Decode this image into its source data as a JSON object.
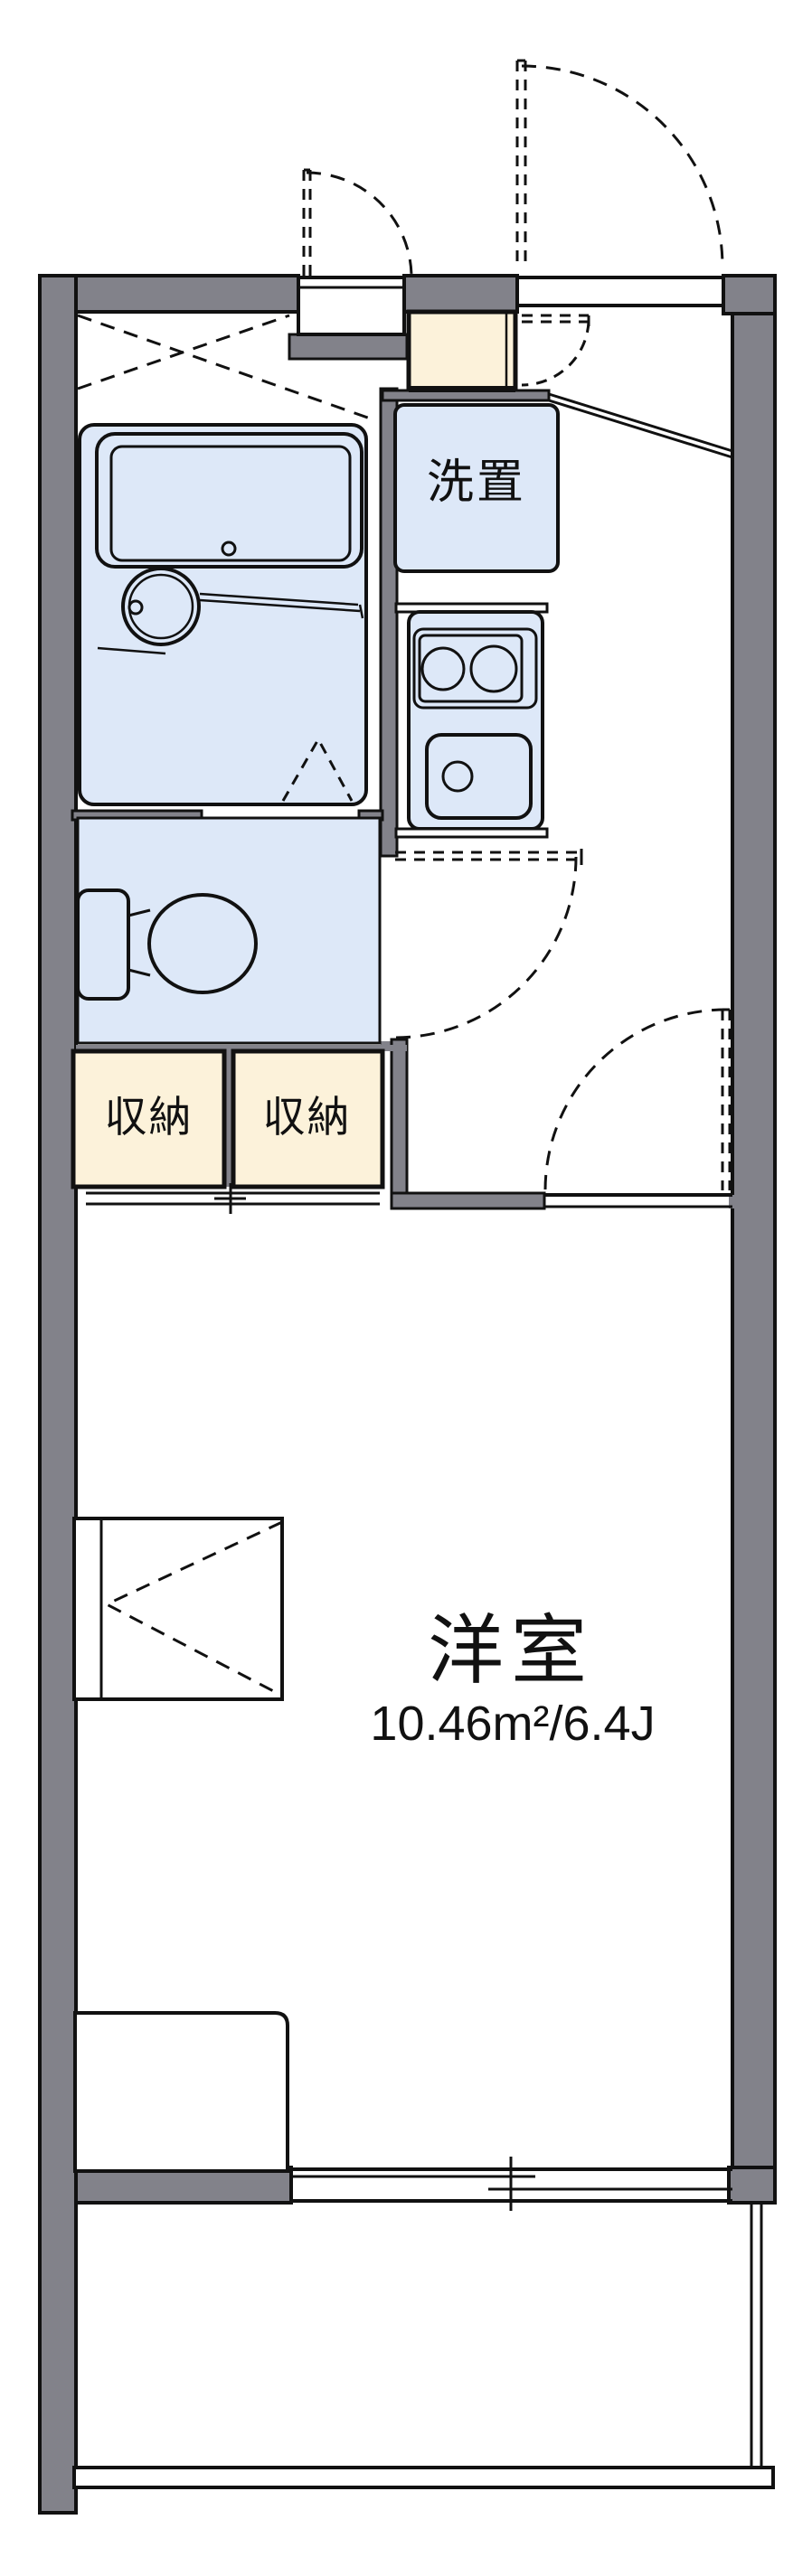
{
  "title": "apartment-floor-plan",
  "labels": {
    "washer_area": "洗置",
    "storage_left": "収納",
    "storage_right": "収納",
    "room_name": "洋室",
    "room_size": "10.46m²/6.4J"
  },
  "colors": {
    "wall": "#82828a",
    "water_blue": "#dde8f8",
    "storage_cream": "#fcf2da",
    "line": "#111111",
    "background": "#ffffff"
  }
}
